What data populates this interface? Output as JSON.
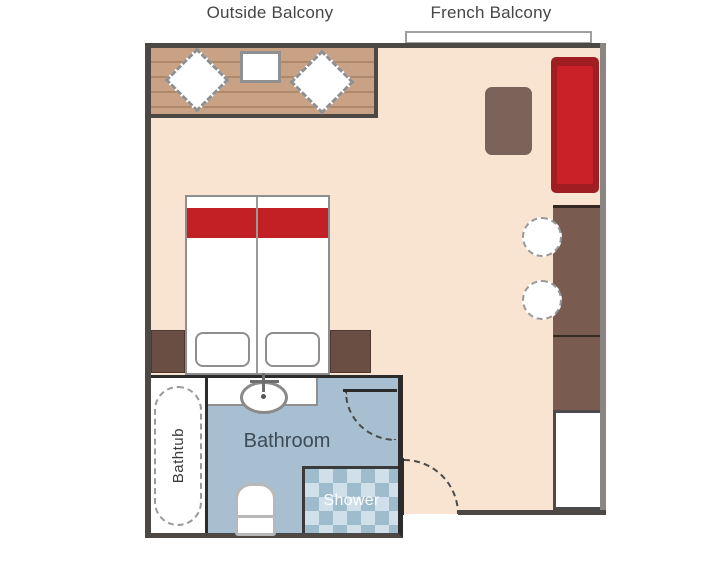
{
  "plan": {
    "outside_balcony": {
      "label": "Outside Balcony"
    },
    "french_balcony": {
      "label": "French Balcony"
    },
    "bathroom": {
      "label": "Bathroom",
      "bathtub_label": "Bathtub",
      "shower_label": "Shower"
    }
  },
  "furniture": {
    "balcony": [
      "deck-chair",
      "deck-table",
      "deck-chair"
    ],
    "bedroom": [
      "double-bed",
      "nightstand-left",
      "nightstand-right",
      "sofa",
      "coffee-table",
      "round-chair",
      "round-chair",
      "cabinet-upper",
      "cabinet-lower",
      "closet"
    ],
    "bathroom": [
      "bathtub",
      "sink",
      "toilet",
      "shower"
    ]
  },
  "colors": {
    "floor": "#f8e4d1",
    "balcony_deck": "#c9a184",
    "wall": "#4e4844",
    "wall_right": "#8b8681",
    "bathroom_floor": "#a7bfd0",
    "shower_tile_light": "#cfe0ea",
    "shower_tile_dark": "#9fbccd",
    "sofa_red": "#c92127",
    "sofa_red_dark": "#a01d22",
    "bed_blanket_red": "#c32026",
    "cabinet_brown": "#795b4f",
    "nightstand_brown": "#6b4e43",
    "table_brown": "#7c635a",
    "label_text": "#464646",
    "bathroom_text": "#3d4b57"
  }
}
